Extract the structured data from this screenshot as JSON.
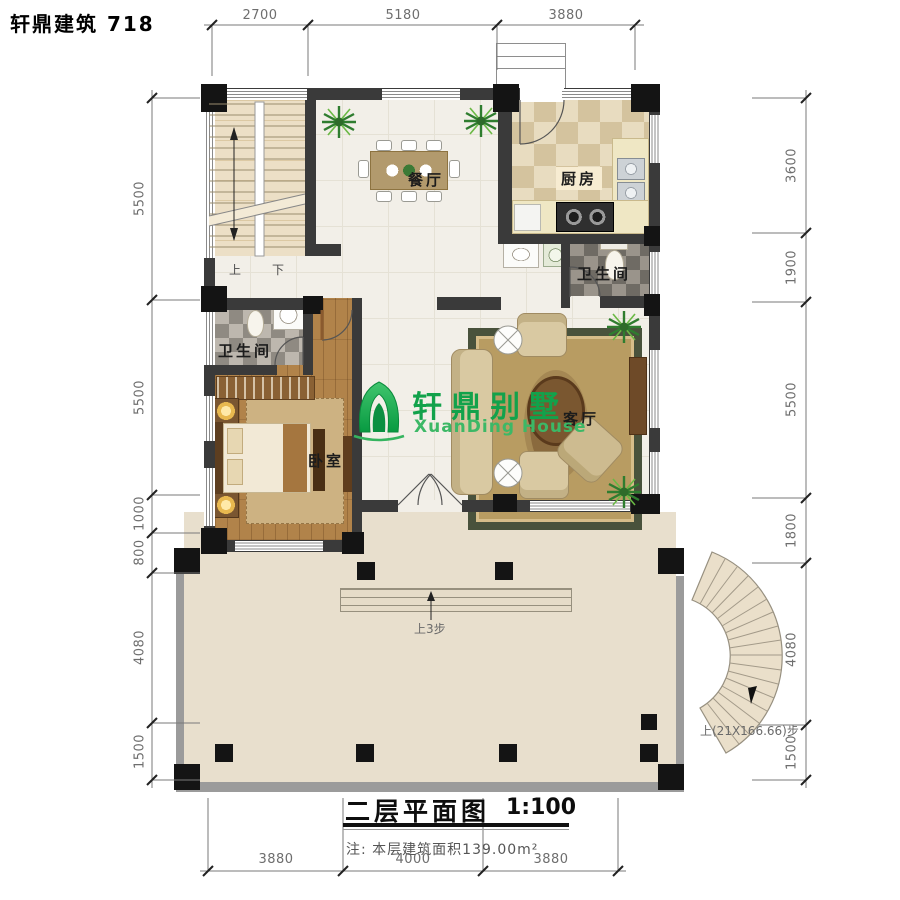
{
  "header": {
    "brand": "轩鼎建筑 718"
  },
  "logo": {
    "name_cn": "轩鼎别墅",
    "name_en": "XuanDing House",
    "green": "#12a24b"
  },
  "rooms": {
    "dining": "餐厅",
    "kitchen": "厨房",
    "bathroom_top": "卫生间",
    "bathroom_left": "卫生间",
    "bedroom": "卧室",
    "living": "客厅"
  },
  "stairs": {
    "up": "上",
    "down": "下",
    "terrace_steps": "上3步",
    "spiral_note": "上(21X166.66)步"
  },
  "dimensions": {
    "top": [
      "2700",
      "5180",
      "3880"
    ],
    "bottom": [
      "3880",
      "4000",
      "3880"
    ],
    "left": [
      "5500",
      "5500",
      "1000",
      "800",
      "4080",
      "1500"
    ],
    "right": [
      "3600",
      "1900",
      "5500",
      "1800",
      "4080",
      "1500"
    ]
  },
  "title_block": {
    "name": "二层平面图",
    "scale": "1:100",
    "note": "注: 本层建筑面积139.00m²"
  },
  "colors": {
    "wall": "#3a3a3a",
    "column": "#141414",
    "terrace": "#e8dfcd",
    "logo_green": "#12a24b"
  }
}
